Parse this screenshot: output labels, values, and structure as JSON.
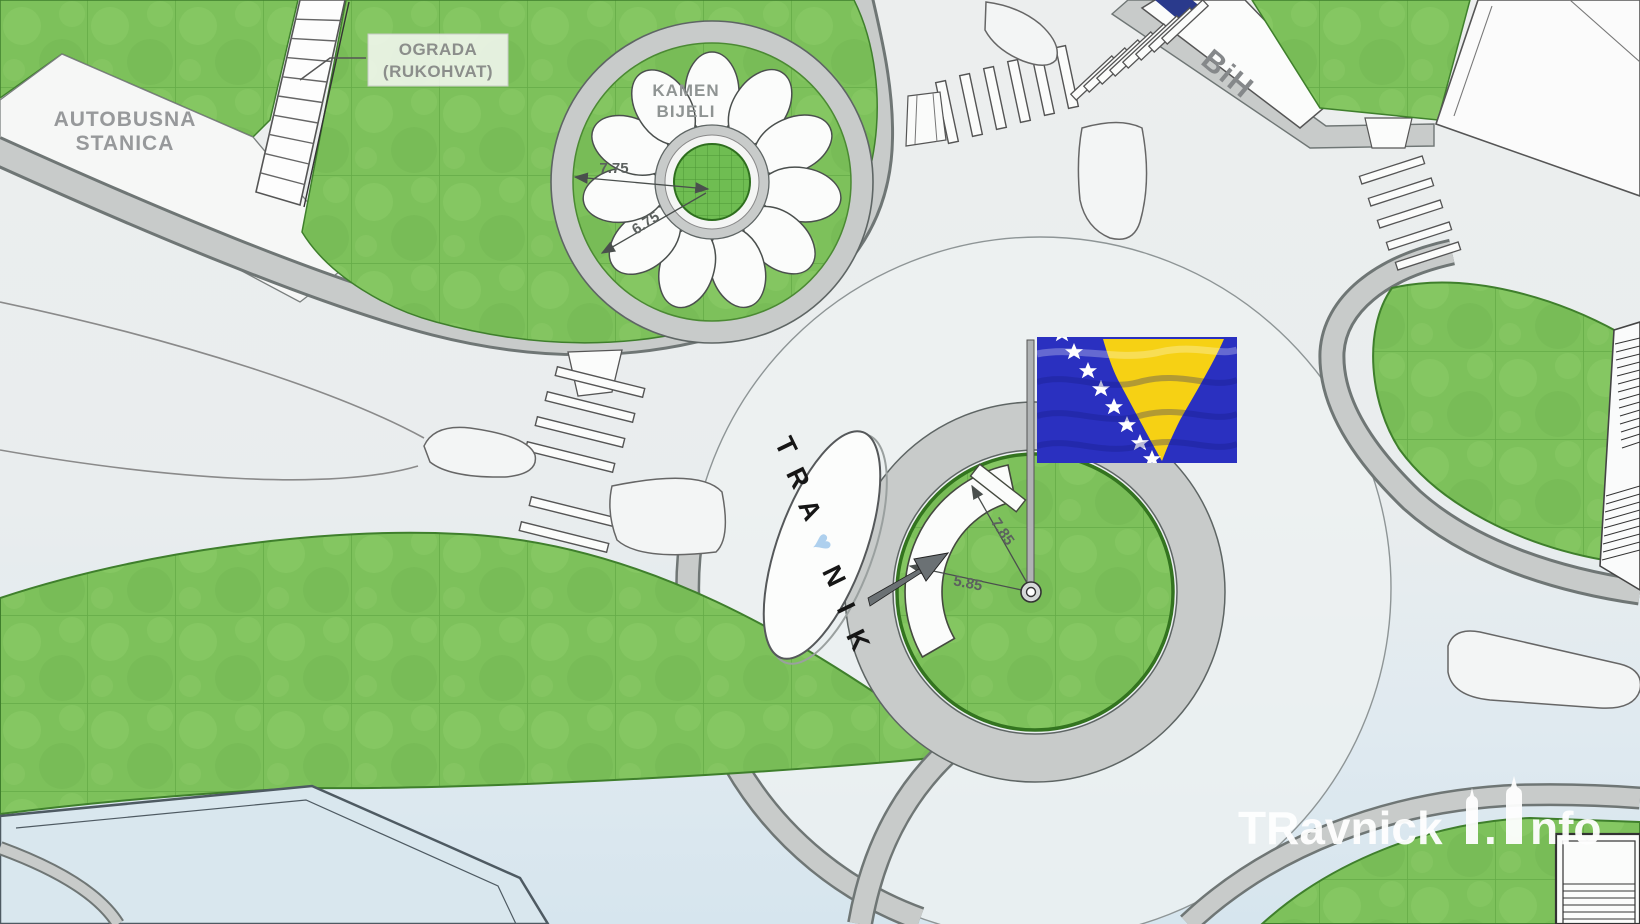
{
  "page": {
    "type": "architectural-site-plan",
    "subject": "Travnik roundabout landscaping plan"
  },
  "labels": {
    "bus_station_line1": "AUTOBUSNA",
    "bus_station_line2": "STANICA",
    "fence_line1": "OGRADA",
    "fence_line2": "(RUKOHVAT)",
    "white_stone_line1": "KAMEN",
    "white_stone_line2": "BIJELI",
    "bih": "BiH"
  },
  "dimensions": {
    "flower_outer": "7.75",
    "flower_inner": "6.75",
    "roundabout_outer": "7.85",
    "roundabout_inner": "5.85"
  },
  "travnik_sign": {
    "letters": [
      "T",
      "R",
      "A",
      "♥",
      "N",
      "I",
      "K"
    ],
    "heart_color": "#aed0ee"
  },
  "watermark": {
    "full": "TRavnickI.Info",
    "part1": "TRavnick",
    "separator": ".",
    "part2": "nfo"
  },
  "colors": {
    "grass": "#7dc15b",
    "grass_light": "#8ccb68",
    "sidewalk": "#c8cbca",
    "sidewalk_edge": "#6f7675",
    "road_light": "#ecefef",
    "road_blue": "#d8e6ee",
    "outline": "#555555",
    "flag_blue": "#2a30c0",
    "flag_yellow": "#f6d114",
    "roof_blue": "#d9e7ee"
  }
}
